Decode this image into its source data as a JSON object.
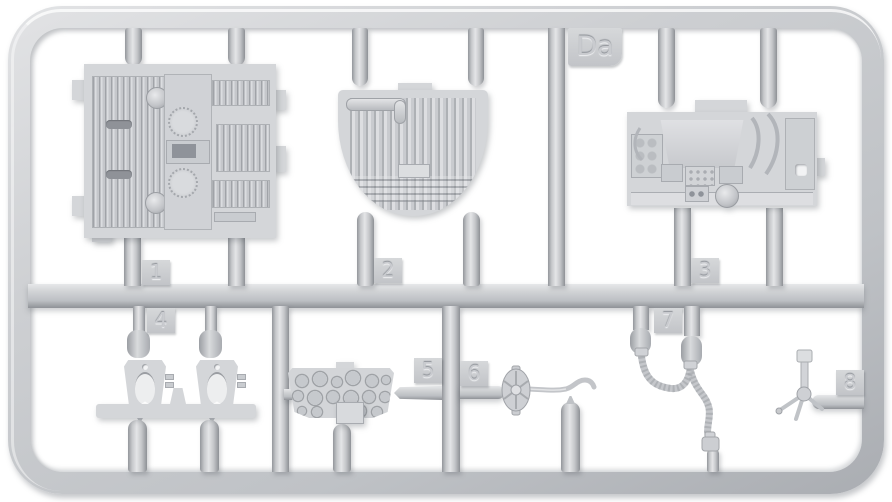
{
  "sprue": {
    "frame_label": "Da",
    "part_tags": [
      {
        "number": "1",
        "part_name": "engine deck louver panel"
      },
      {
        "number": "2",
        "part_name": "radiator piping panel"
      },
      {
        "number": "3",
        "part_name": "engine bulkhead assembly"
      },
      {
        "number": "4",
        "part_name": "mount brackets on rail"
      },
      {
        "number": "5",
        "part_name": "perforated bulkhead plate"
      },
      {
        "number": "6",
        "part_name": "handwheel control lever"
      },
      {
        "number": "7",
        "part_name": "flexible braided hose"
      },
      {
        "number": "8",
        "part_name": "three-leg fitting"
      }
    ],
    "colors": {
      "plastic": "#cdd0d3",
      "plastic_light": "#e4e5e7",
      "plastic_shadow": "#9b9ea3",
      "background": "#ffffff"
    }
  }
}
